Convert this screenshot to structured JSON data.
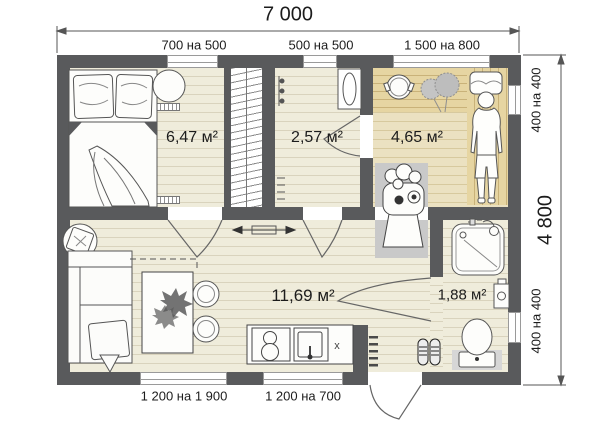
{
  "dimensions": {
    "total_width": "7 000",
    "total_height": "4 800"
  },
  "windows": {
    "top": [
      "700 на 500",
      "500 на 500",
      "1 500 на 800"
    ],
    "right": [
      "400 на 400",
      "400 на 400"
    ],
    "bottom": [
      "1 200 на 1 900",
      "1 200 на 700"
    ]
  },
  "rooms": {
    "bedroom": {
      "area": "6,47 м²"
    },
    "hallway": {
      "area": "2,57 м²"
    },
    "sauna": {
      "area": "4,65 м²"
    },
    "living": {
      "area": "11,69 м²"
    },
    "bathroom": {
      "area": "1,88 м²"
    }
  },
  "annotations": {
    "kitchen_mark": "x"
  },
  "icons": {
    "stove": "sauna-stove-icon",
    "plant": "plant-icon",
    "person": "person-figure-icon",
    "shoes": "shoes-icon"
  },
  "colors": {
    "wall": "#595a5c",
    "floor": "#efecdb",
    "floor_line": "#d9d3bd",
    "sauna_floor": "#ebe1c1",
    "sauna_line": "#d7c99e",
    "bench": "#e6d5a2",
    "bench_line": "#c9b279",
    "equipment_pad": "#c9c9c9"
  }
}
